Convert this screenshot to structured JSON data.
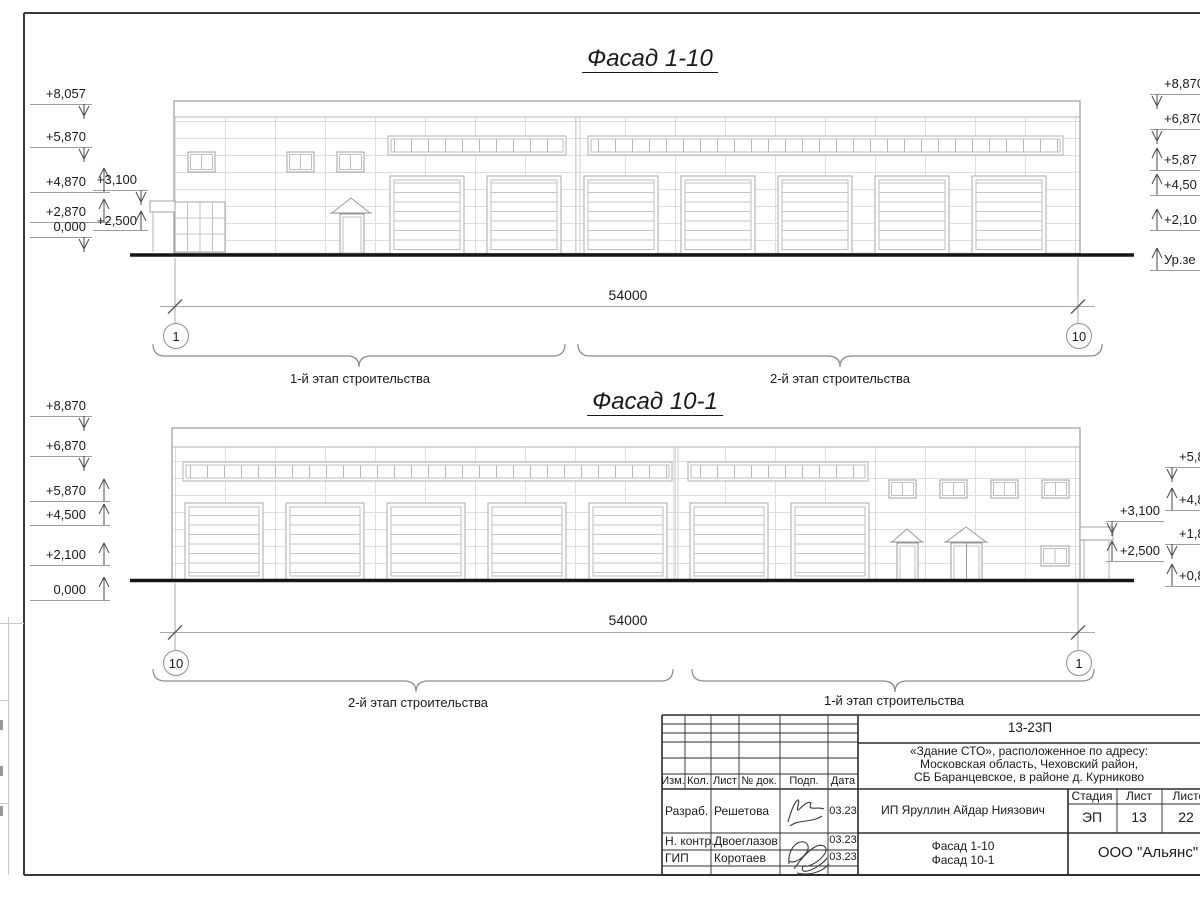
{
  "drawing": {
    "facade_top": {
      "title": "Фасад 1-10",
      "marks_left": [
        "+8,057",
        "+5,870",
        "+4,870",
        "+2,870",
        "0,000"
      ],
      "marks_inner": [
        "+3,100",
        "+2,500"
      ],
      "marks_right": [
        "+8,870",
        "+6,870",
        "+5,87",
        "+4,50",
        "+2,10",
        "Ур.зе"
      ],
      "dimension": "54000",
      "axis_left": "1",
      "axis_right": "10",
      "stage_label_left": "1-й этап строительства",
      "stage_label_right": "2-й этап строительства"
    },
    "facade_bottom": {
      "title": "Фасад 10-1",
      "marks_left": [
        "+8,870",
        "+6,870",
        "+5,870",
        "+4,500",
        "+2,100",
        "0,000"
      ],
      "marks_inner": [
        "+3,100",
        "+2,500"
      ],
      "marks_right": [
        "+5,8",
        "+4,8",
        "+1,8",
        "+0,8"
      ],
      "dimension": "54000",
      "axis_left": "10",
      "axis_right": "1",
      "stage_label_left": "2-й этап строительства",
      "stage_label_right": "1-й этап строительства"
    },
    "title_block": {
      "code": "13-23П",
      "project_line1": "«Здание СТО», расположенное по адресу:",
      "project_line2": "Московская область, Чеховский район,",
      "project_line3": "СБ Баранцевское, в районе д. Курниково",
      "cols": [
        "Изм.",
        "Кол.",
        "Лист",
        "№ док.",
        "Подп.",
        "Дата"
      ],
      "rows": [
        {
          "role": "Разраб.",
          "name": "Решетова",
          "date": "03.23"
        },
        {
          "role": "Н. контр.",
          "name": "Двоеглазов",
          "date": "03.23"
        },
        {
          "role": "ГИП",
          "name": "Коротаев",
          "date": "03.23"
        }
      ],
      "client": "ИП Яруллин Айдар Ниязович",
      "stage_header": "Стадия",
      "sheet_header": "Лист",
      "sheets_header": "Листов",
      "stage": "ЭП",
      "sheet": "13",
      "sheets": "22",
      "sheet_name_line1": "Фасад 1-10",
      "sheet_name_line2": "Фасад 10-1",
      "company": "ООО \"Альянс\""
    }
  }
}
